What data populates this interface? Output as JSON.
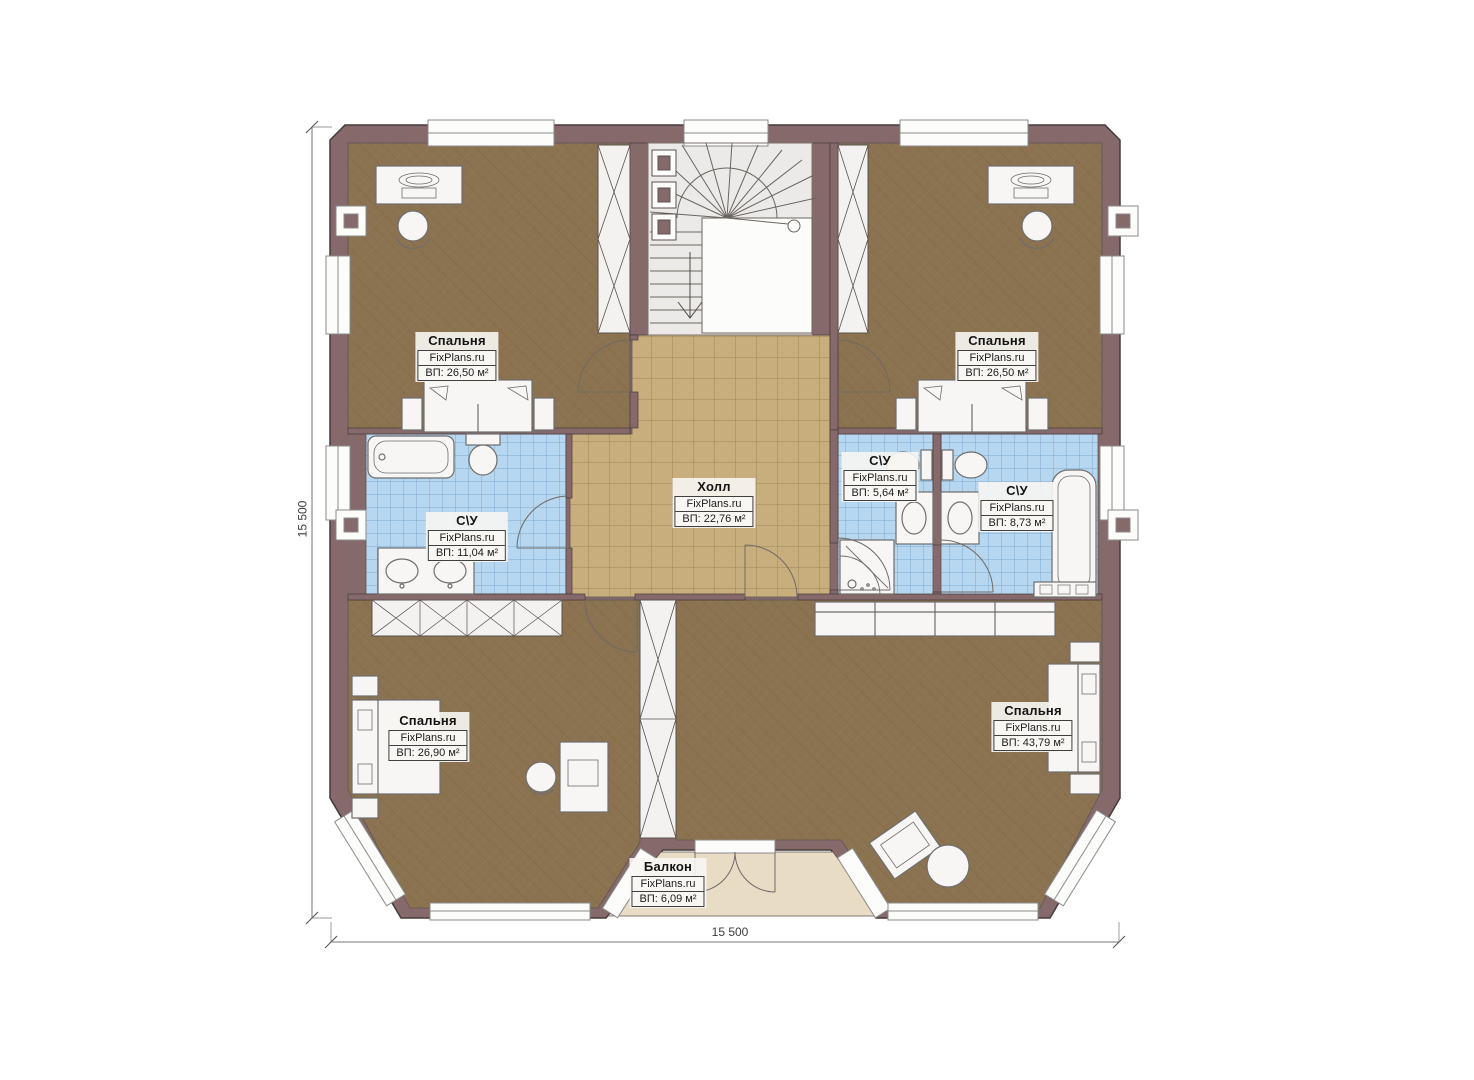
{
  "plan": {
    "type": "floor-plan",
    "brand_watermark": "FixPlans.ru"
  },
  "dimensions": {
    "left": "15 500",
    "bottom": "15 500"
  },
  "rooms": [
    {
      "id": "bedroom-top-left",
      "name": "Спальня",
      "brand": "FixPlans.ru",
      "area": "ВП: 26,50 м²"
    },
    {
      "id": "bedroom-top-right",
      "name": "Спальня",
      "brand": "FixPlans.ru",
      "area": "ВП: 26,50 м²"
    },
    {
      "id": "hall",
      "name": "Холл",
      "brand": "FixPlans.ru",
      "area": "ВП: 22,76 м²"
    },
    {
      "id": "bathroom-left",
      "name": "С\\У",
      "brand": "FixPlans.ru",
      "area": "ВП: 11,04 м²"
    },
    {
      "id": "bathroom-middle",
      "name": "С\\У",
      "brand": "FixPlans.ru",
      "area": "ВП: 5,64 м²"
    },
    {
      "id": "bathroom-right",
      "name": "С\\У",
      "brand": "FixPlans.ru",
      "area": "ВП: 8,73 м²"
    },
    {
      "id": "bedroom-bottom-left",
      "name": "Спальня",
      "brand": "FixPlans.ru",
      "area": "ВП: 26,90 м²"
    },
    {
      "id": "bedroom-bottom-right",
      "name": "Спальня",
      "brand": "FixPlans.ru",
      "area": "ВП: 43,79 м²"
    },
    {
      "id": "balcony",
      "name": "Балкон",
      "brand": "FixPlans.ru",
      "area": "ВП: 6,09 м²"
    }
  ],
  "colors": {
    "wall": "#85696b",
    "bedroom_floor": "#8b7251",
    "hall_floor": "#c9ae7d",
    "bathroom_floor": "#b7d6ef",
    "balcony_floor": "#e9dcc4",
    "background": "#ffffff"
  }
}
